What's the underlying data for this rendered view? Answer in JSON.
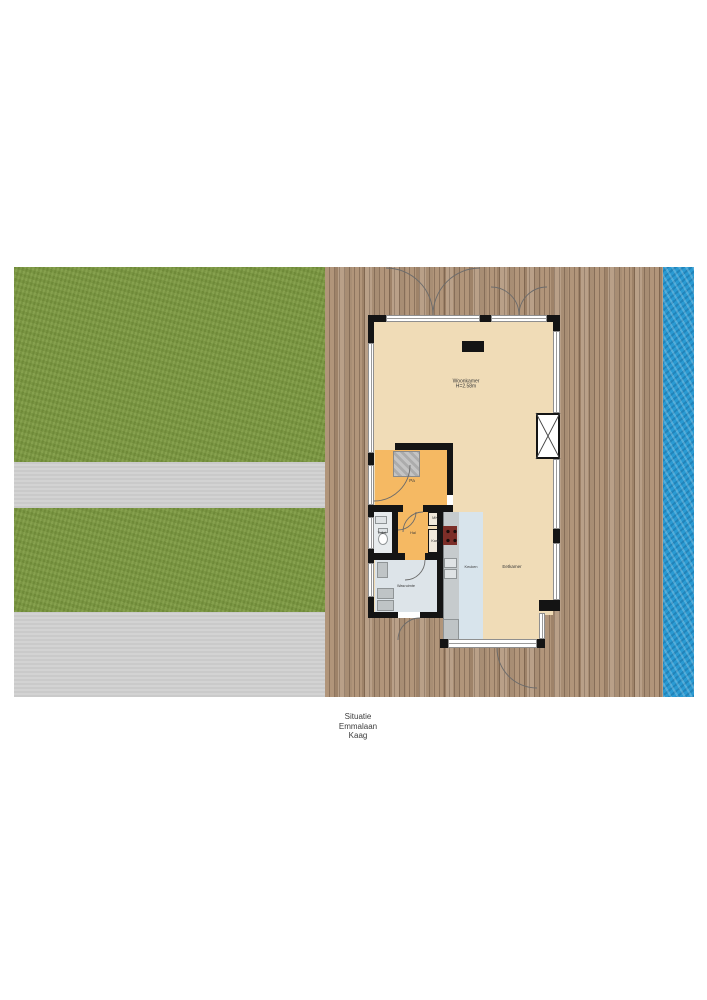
{
  "caption": {
    "lines": [
      "Situatie",
      "Emmalaan",
      "Kaag"
    ]
  },
  "rooms": {
    "woonkamer": {
      "label": "Woonkamer",
      "sub": "H=2.58m"
    },
    "pa": {
      "label": "Pa"
    },
    "toilet": {
      "label": "Toilet"
    },
    "hal": {
      "label": "Hal"
    },
    "mk": {
      "label": "MK"
    },
    "kast": {
      "label": "Kast"
    },
    "wasruimte": {
      "label": "Wasruimte"
    },
    "keuken": {
      "label": "Keuken"
    },
    "eetkamer": {
      "label": "Eetkamer"
    }
  },
  "colors": {
    "grass": "#7d9a41",
    "path": "#d1d1d1",
    "deck": "#b1957a",
    "deck_dark": "#8d745e",
    "water": "#2a9ad2",
    "floor_main": "#f0dcb7",
    "floor_hall": "#f5b963",
    "floor_kitchen": "#d8e4ec",
    "floor_wet": "#dde4e9",
    "wall": "#141414",
    "counter": "#c6cbcd",
    "stove": "#7c2e28"
  }
}
